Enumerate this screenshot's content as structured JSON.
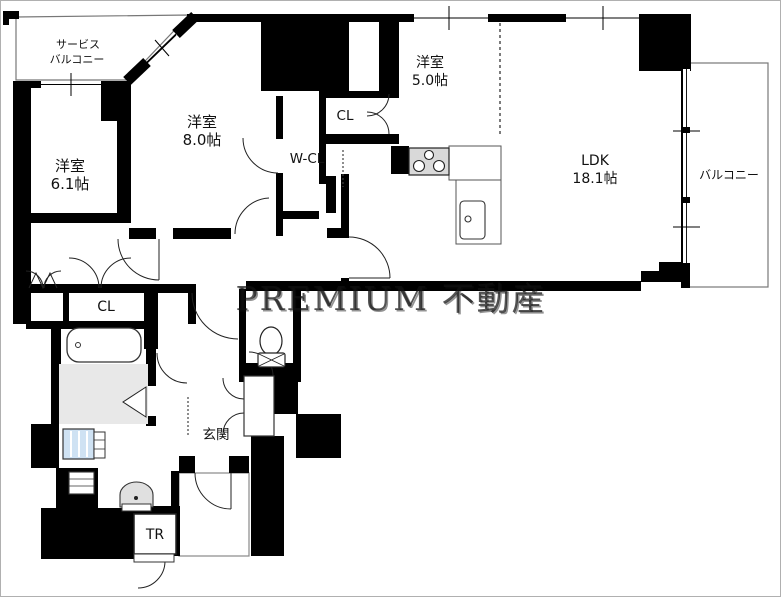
{
  "watermark": "PREMIUM 不動産",
  "colors": {
    "wall": "#000000",
    "bath_floor": "#e8e8e8",
    "stove": "#d9d9d9",
    "washer": "#cfe2f3"
  },
  "rooms": {
    "service_balcony": {
      "line1": "サービス",
      "line2": "バルコニー"
    },
    "bedroom_61": {
      "name": "洋室",
      "size": "6.1帖"
    },
    "bedroom_80": {
      "name": "洋室",
      "size": "8.0帖"
    },
    "bedroom_50": {
      "name": "洋室",
      "size": "5.0帖"
    },
    "ldk": {
      "name": "LDK",
      "size": "18.1帖"
    },
    "balcony": {
      "label": "バルコニー"
    },
    "walk_in_closet": {
      "label": "W-CL"
    },
    "closet_upper": {
      "label": "CL"
    },
    "closet_lower": {
      "label": "CL"
    },
    "entrance": {
      "label": "玄関"
    },
    "trunk_room": {
      "label": "TR"
    }
  }
}
